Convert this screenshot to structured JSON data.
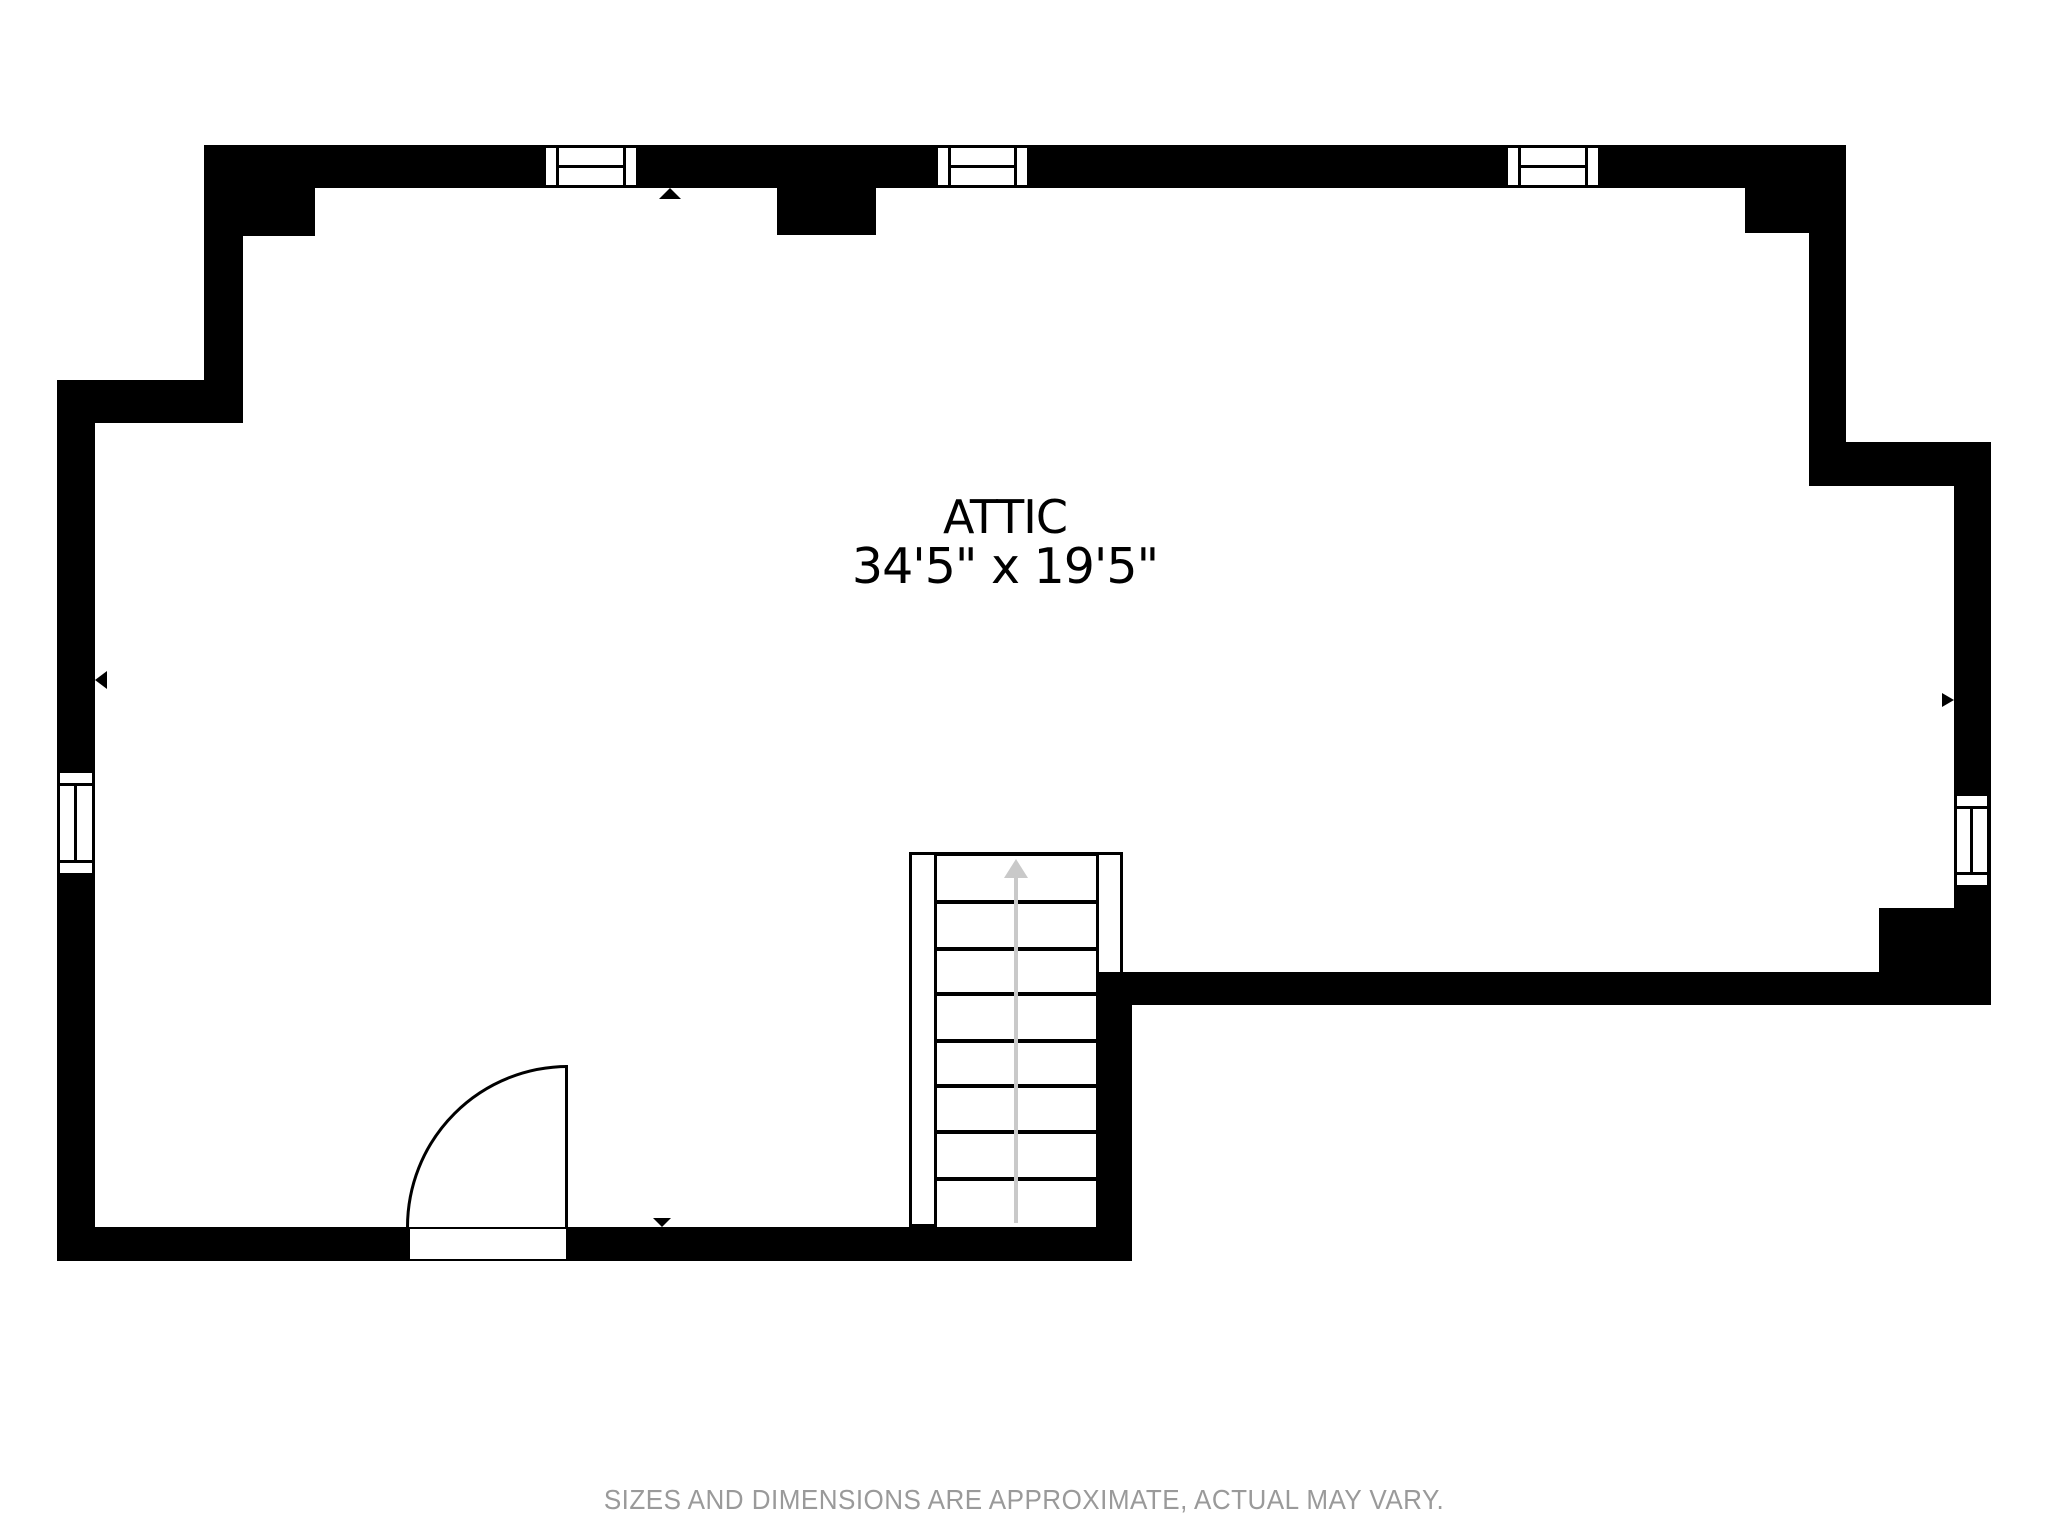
{
  "plan": {
    "room": {
      "label": "ATTIC",
      "dimensions": "34'5\" x 19'5\""
    },
    "footer": {
      "disclaimer": "SIZES AND DIMENSIONS ARE APPROXIMATE, ACTUAL MAY VARY."
    },
    "colors": {
      "wall": "#000000",
      "interior": "#ffffff",
      "stair_arrow": "#c9c9c9",
      "footer_text": "#9a9a9a"
    },
    "stairs": {
      "direction": "up",
      "tread_count": 8
    },
    "features": {
      "windows": [
        "top-window-1",
        "top-window-2",
        "top-window-3",
        "left-window",
        "right-window"
      ],
      "door": "hinged-door-bottom-wall",
      "markers": [
        "up-marker-top-wall",
        "down-marker-bottom-wall",
        "left-marker-left-wall",
        "right-marker-right-wall"
      ]
    }
  }
}
